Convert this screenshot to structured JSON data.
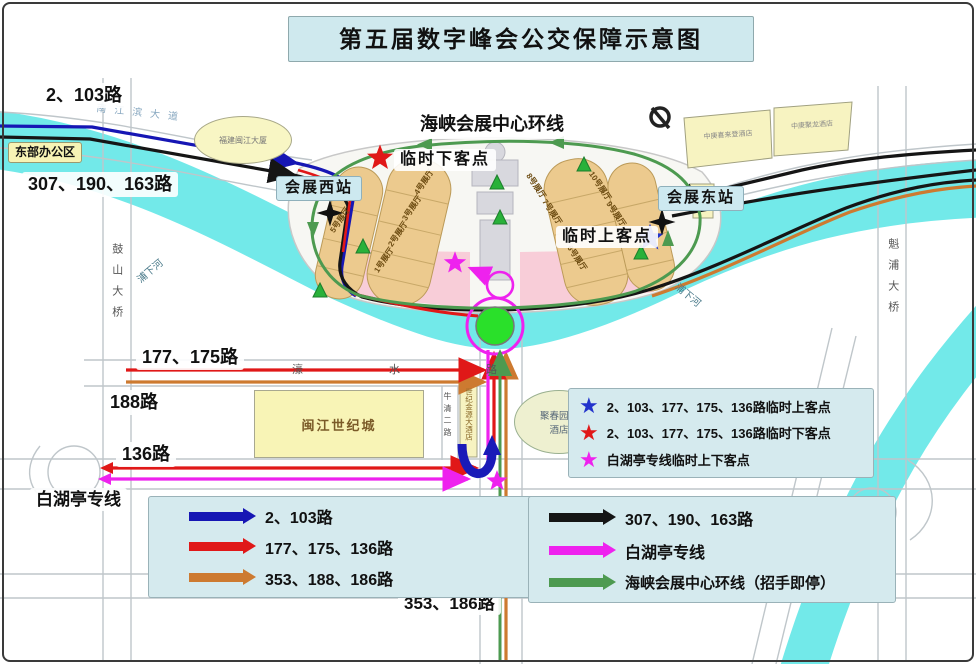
{
  "title": "第五届数字峰会公交保障示意图",
  "icons": {
    "star": "★"
  },
  "labels": {
    "routes_2_103": "2、103路",
    "east_office": "东部办公区",
    "routes_307_190_163": "307、190、163路",
    "loop_line": "海峡会展中心环线",
    "temp_dropoff": "临时下客点",
    "temp_pickup": "临时上客点",
    "west_station": "会展西站",
    "east_station": "会展东站",
    "routes_177_175": "177、175路",
    "route_188": "188路",
    "route_136": "136路",
    "baihuting_line": "白湖亭专线",
    "routes_353_186": "353、186路"
  },
  "buildings": {
    "fujian_minjiang_tower": "福建闽江大厦",
    "hotel_left": "中庚喜来登酒店",
    "hotel_right": "中庚聚龙酒店",
    "minjiang_century_city": "闽江世纪城",
    "century_golden_resources_hotel": "世纪金源大酒店",
    "juchunyuan_hotel": "聚春园大酒店"
  },
  "roads": {
    "nanjiangbin_avenue": "南江滨大道",
    "gushan_bridge": "鼓山大桥",
    "kuipu_bridge": "魁浦大桥",
    "haoshui_road": "濠水路",
    "niuqing_er_road": "牛清二路",
    "linpu_road": "林浦路",
    "zexu_avenue": "则徐大道",
    "puxia_river_left": "浦下河",
    "puxia_river_right": "浦下河"
  },
  "halls": {
    "w5": "5号展厅",
    "w4": "4号展厅",
    "w3": "3号展厅",
    "w2": "2号展厅",
    "w1": "1号展厅",
    "e8": "8号展厅",
    "e7": "7号展厅",
    "e6": "6号展厅",
    "e10": "10号展厅",
    "e9": "9号展厅"
  },
  "star_legend": {
    "items": [
      {
        "color": "#2233cc",
        "label": "2、103、177、175、136路临时上客点"
      },
      {
        "color": "#e01818",
        "label": "2、103、177、175、136路临时下客点"
      },
      {
        "color": "#ee22ee",
        "label": "白湖亭专线临时上下客点"
      }
    ]
  },
  "route_legend": {
    "left": [
      {
        "color": "#1616b4",
        "label": "2、103路"
      },
      {
        "color": "#e01818",
        "label": "177、175、136路"
      },
      {
        "color": "#cd7a30",
        "label": "353、188、186路"
      }
    ],
    "right": [
      {
        "color": "#151515",
        "label": "307、190、163路"
      },
      {
        "color": "#ee22ee",
        "label": "白湖亭专线"
      },
      {
        "color": "#4d9a50",
        "label": "海峡会展中心环线（招手即停）"
      }
    ]
  }
}
